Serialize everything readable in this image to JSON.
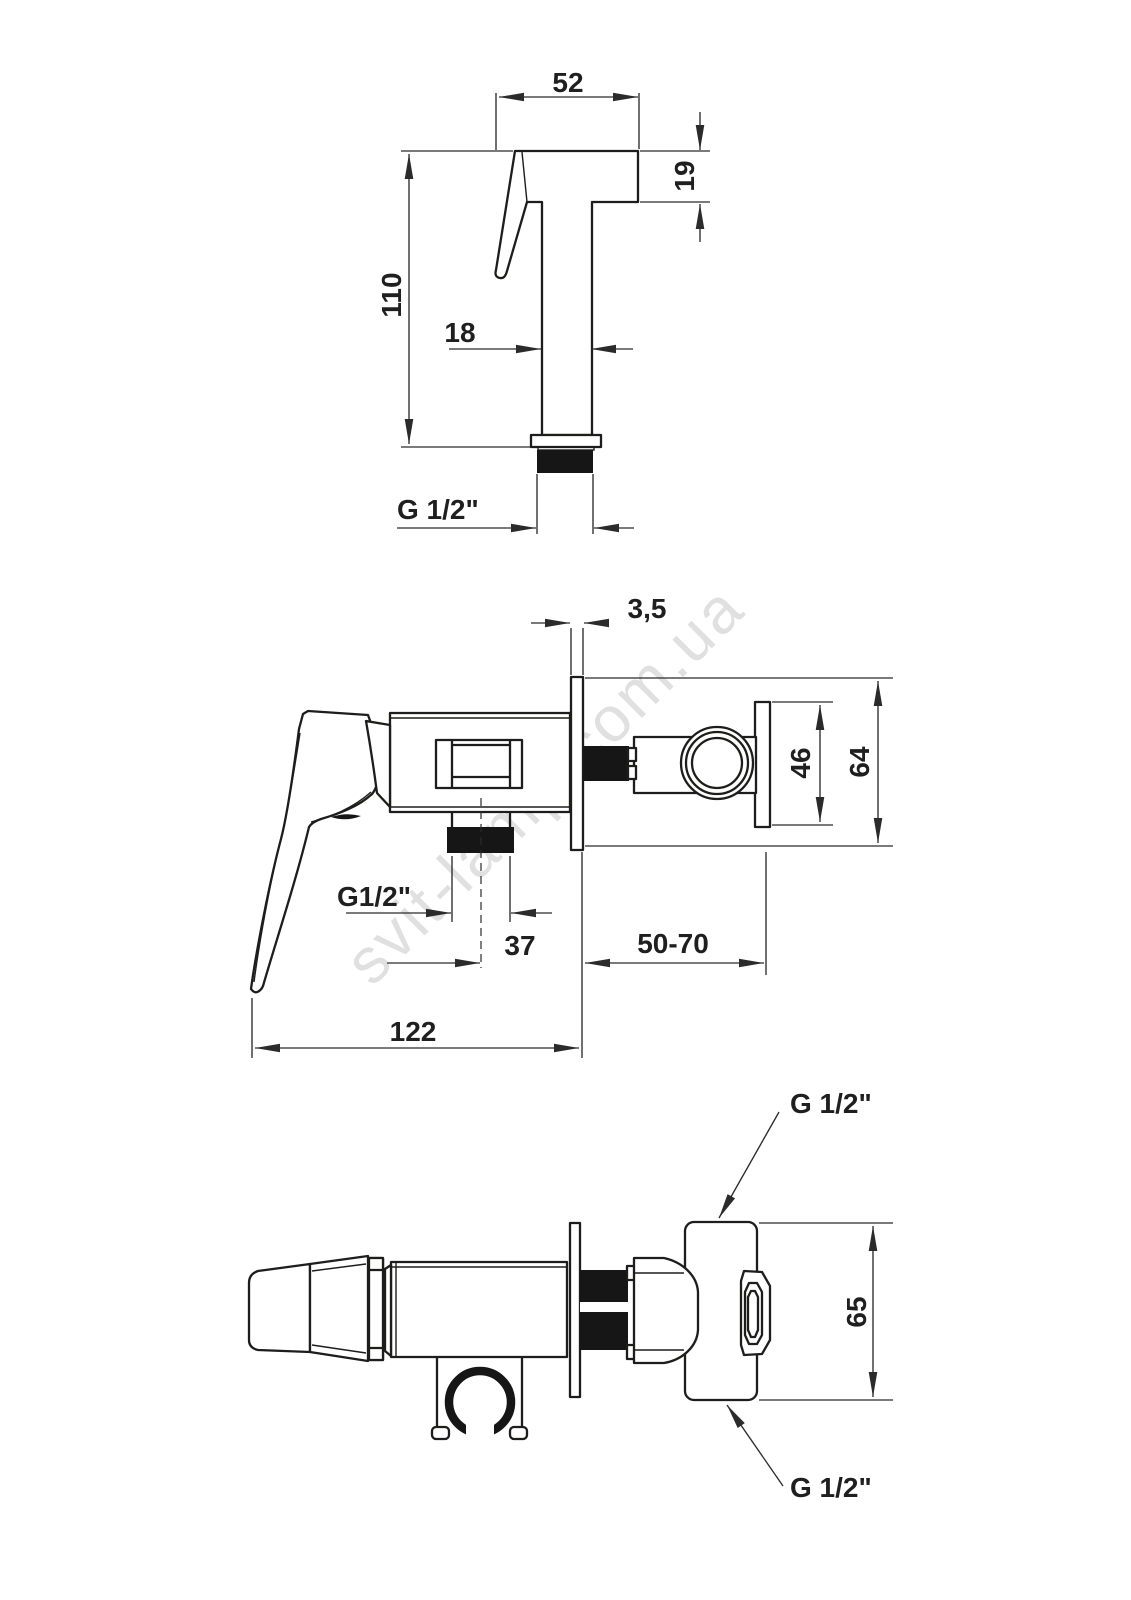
{
  "watermark": "svit-lamp.com.ua",
  "colors": {
    "line": "#1d1d1b",
    "thread_fill": "#161616",
    "watermark": "#c7c7c7"
  },
  "views": {
    "hand_shower_side": {
      "dims": {
        "head_width": "52",
        "head_height": "19",
        "total_height": "110",
        "stem_width": "18",
        "connection_thread": "G 1/2\""
      }
    },
    "mixer_side": {
      "dims": {
        "escutcheon_thickness": "3,5",
        "union_plate_height": "46",
        "escutcheon_height": "64",
        "outlet_thread": "G1/2\"",
        "outlet_to_wall": "37",
        "wall_to_union": "50-70",
        "total_length": "122"
      }
    },
    "mixer_top": {
      "dims": {
        "union_height": "65",
        "thread_top": "G 1/2\"",
        "thread_bottom": "G 1/2\""
      }
    }
  }
}
